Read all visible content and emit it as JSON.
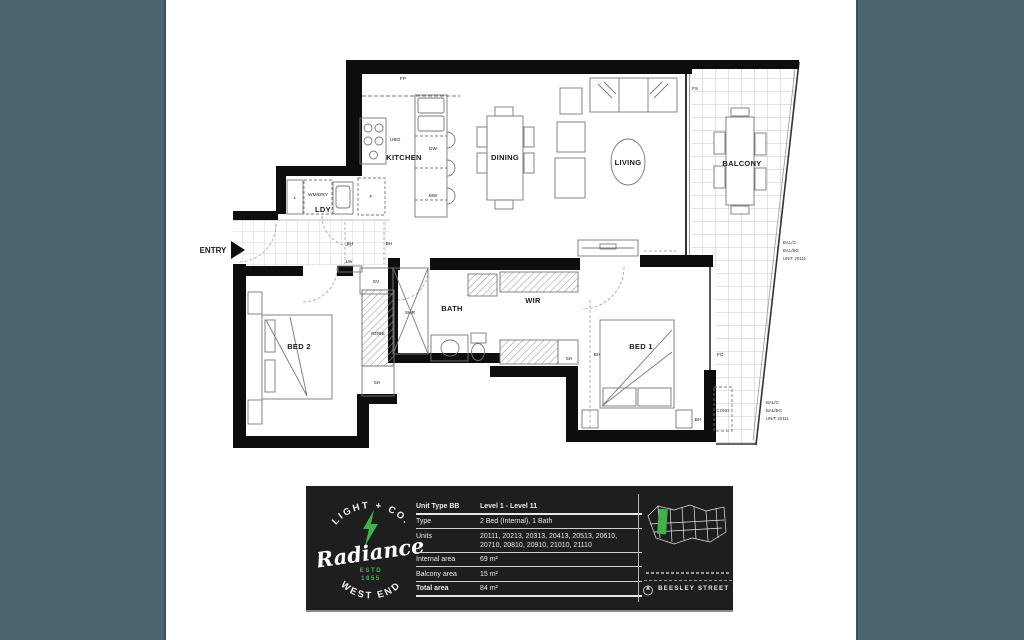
{
  "colors": {
    "teal_bg": "#4b6670",
    "panel_bg": "#1e1e1e",
    "accent_green": "#43b049",
    "wall_black": "#0d0d0d"
  },
  "plan": {
    "entry": "ENTRY",
    "labels": {
      "kitchen": "KITCHEN",
      "dining": "DINING",
      "living": "LIVING",
      "balcony": "BALCONY",
      "ldy": "LDY",
      "bath": "BATH",
      "wir": "WIR",
      "bed1": "BED 1",
      "bed2": "BED 2",
      "fp": "FP",
      "fs": "FS",
      "ubo": "UBO",
      "dw": "DW",
      "mw": "MW",
      "f": "F",
      "l": "L",
      "wmdry": "WM/DRY",
      "bh": "BH",
      "lw": "LW",
      "sv": "SV",
      "shr": "SHR",
      "sh": "SH",
      "robe": "ROBE",
      "fg": "FG",
      "cond": "COND"
    },
    "notes": {
      "upper": {
        "l1": "BAL/G",
        "l2": "BAL/BG",
        "l3": "UNIT 20111"
      },
      "lower": {
        "l1": "BAL/G",
        "l2": "BAL/BG",
        "l3": "UNIT 20111"
      }
    }
  },
  "panel": {
    "logo": {
      "arc_top": "LIGHT + CO.",
      "name": "Radiance",
      "estd": "ESTD",
      "year": "1855",
      "arc_bottom": "WEST END"
    },
    "table": {
      "unit_type": "Unit Type BB",
      "levels": "Level 1 - Level 11",
      "type_label": "Type",
      "type_value": "2 Bed (Internal), 1 Bath",
      "units_label": "Units",
      "units_line1": "20111, 20213, 20313, 20413, 20513, 20610,",
      "units_line2": "20710, 20810, 20910, 21010, 21110",
      "internal_label": "Internal area",
      "internal_value": "69 m²",
      "balcony_label": "Balcony area",
      "balcony_value": "15 m²",
      "total_label": "Total area",
      "total_value": "84 m²"
    },
    "street": "BEESLEY STREET"
  }
}
